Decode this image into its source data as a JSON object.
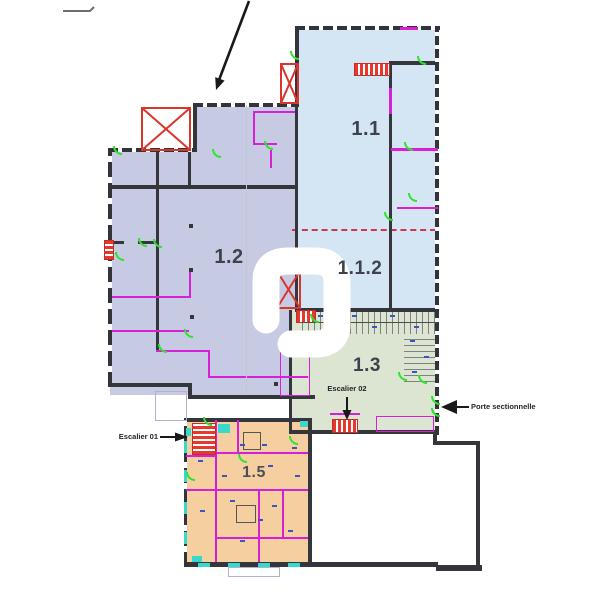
{
  "plan": {
    "zones": [
      {
        "id": "zone-1-1",
        "label": "1.1",
        "color": "#d4e6f4"
      },
      {
        "id": "zone-1-2",
        "label": "1.2",
        "color": "#c7cae3"
      },
      {
        "id": "zone-1-1-2",
        "label": "1.1.2",
        "color": "#d4e6f4"
      },
      {
        "id": "zone-1-3",
        "label": "1.3",
        "color": "#dbe5d1"
      },
      {
        "id": "zone-1-5",
        "label": "1.5",
        "color": "#f6cfa0"
      }
    ],
    "callouts": [
      {
        "id": "escalier-01",
        "label": "Escalier 01"
      },
      {
        "id": "escalier-02",
        "label": "Escalier 02"
      },
      {
        "id": "porte-sectionnelle",
        "label": "Porte sectionnelle"
      }
    ],
    "palette": {
      "wall": "#35363c",
      "partition_magenta": "#d81fd8",
      "stair_red": "#e8372c",
      "door_green": "#2fe32f",
      "window_teal": "#38d8cc",
      "section_line_red_dashed": "#cf3550",
      "hatch_base": "#dde4d3",
      "watermark": "#ffffff"
    }
  }
}
